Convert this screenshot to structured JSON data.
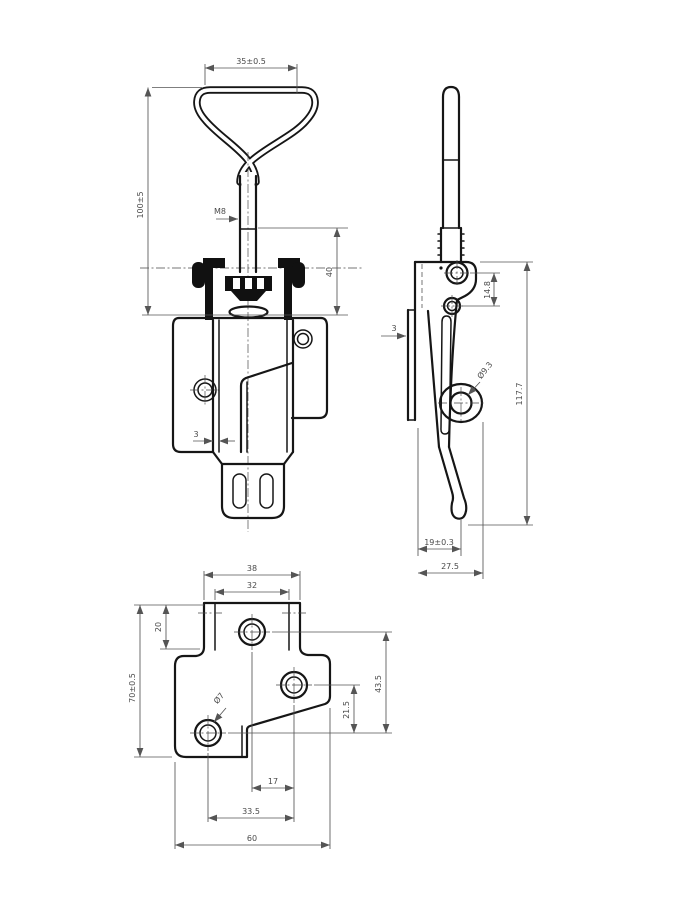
{
  "drawing": {
    "subject": "adjustable toggle latch, 3-view technical drawing",
    "colors": {
      "background": "#ffffff",
      "object_line": "#161616",
      "dimension_line": "#555555"
    },
    "front": {
      "handle_width": "35±0.5",
      "overall_height": "100±5",
      "thread": "M8",
      "rod_length": "40",
      "wall_thickness": "3"
    },
    "side": {
      "rivet_pitch": "14.8",
      "plate_thickness": "3",
      "keeper_hole_dia": "Ø9.3",
      "overall_height": "117.7",
      "hook_offset": "19±0.3",
      "overall_depth": "27.5"
    },
    "flat": {
      "tab_outer_width": "38",
      "tab_inner_width": "32",
      "tab_depth": "20",
      "plate_length": "70±0.5",
      "hole_span_y": "43.5",
      "hole_mid_y": "21.5",
      "mount_hole_dia": "Ø7",
      "hole_pitch_x": "17",
      "hole_span_x": "33.5",
      "plate_width": "60"
    }
  }
}
